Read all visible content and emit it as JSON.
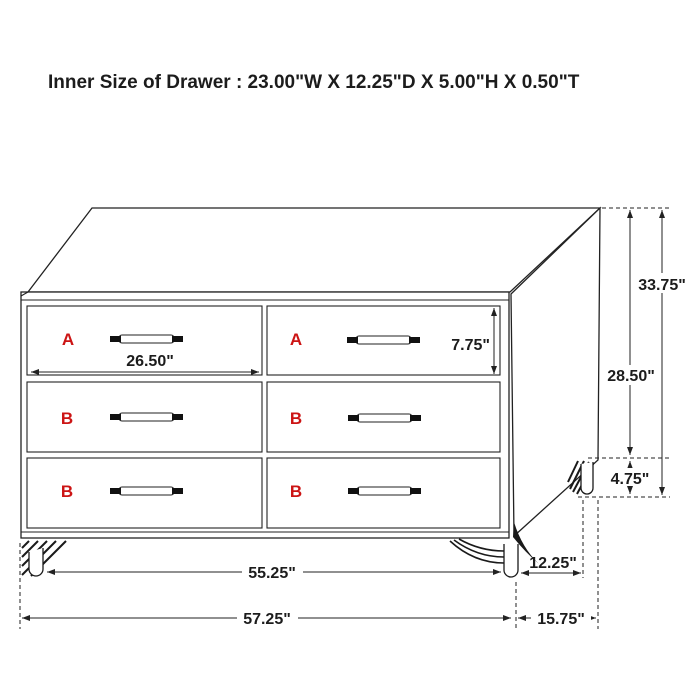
{
  "title": "Inner Size of Drawer : 23.00\"W X 12.25\"D X 5.00\"H X 0.50\"T",
  "colors": {
    "line": "#222222",
    "drawer_label_red": "#cc1414",
    "background": "#ffffff"
  },
  "drawers": {
    "top_left": "A",
    "top_right": "A",
    "middle_left": "B",
    "middle_right": "B",
    "bottom_left": "B",
    "bottom_right": "B"
  },
  "dimensions": {
    "inner_drawer_width": "26.50\"",
    "drawer_face_height": "7.75\"",
    "total_height": "33.75\"",
    "case_height": "28.50\"",
    "leg_height": "4.75\"",
    "case_width": "55.25\"",
    "leg_depth_span": "12.25\"",
    "total_width": "57.25\"",
    "total_depth": "15.75\""
  }
}
